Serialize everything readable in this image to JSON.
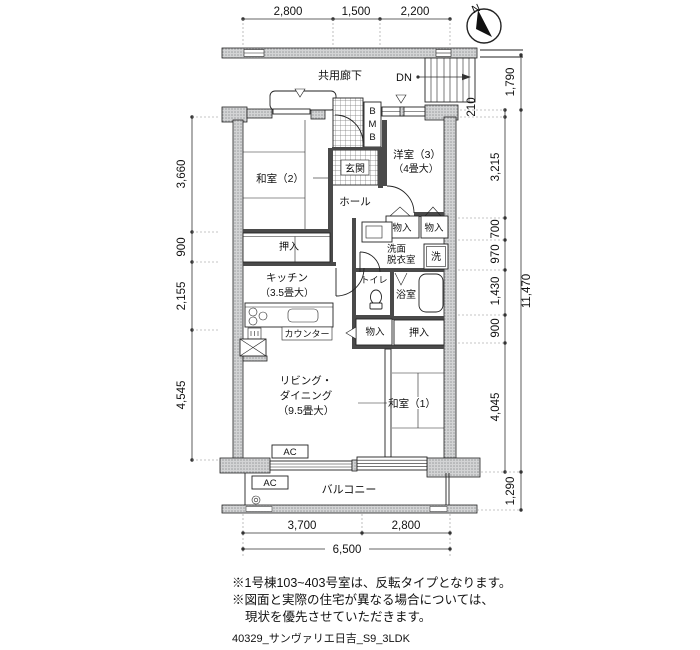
{
  "compass": {
    "north_label": "N"
  },
  "corridor": {
    "label": "共用廊下",
    "stairs_label": "DN"
  },
  "rooms": {
    "washitsu2": "和室（2）",
    "washitsu1": "和室（1）",
    "yoshitsu3_line1": "洋室（3）",
    "yoshitsu3_line2": "（4畳大）",
    "genkan": "玄関",
    "hall": "ホール",
    "kitchen_line1": "キッチン",
    "kitchen_line2": "（3.5畳大）",
    "living_line1": "リビング・",
    "living_line2": "ダイニング",
    "living_line3": "（9.5畳大）",
    "senmen_line1": "洗面",
    "senmen_line2": "脱衣室",
    "washer": "洗",
    "toilet": "トイレ",
    "bath": "浴室",
    "oshiire_top": "押入",
    "oshiire_right": "押入",
    "monoire_a": "物入",
    "monoire_b": "物入",
    "monoire_c": "物入",
    "counter": "カウンター",
    "balcony": "バルコニー",
    "mb": [
      "B",
      "M",
      "B"
    ],
    "ac1": "AC",
    "ac2": "AC"
  },
  "dimensions": {
    "top": [
      "2,800",
      "1,500",
      "2,200"
    ],
    "left": [
      "3,660",
      "900",
      "2,155",
      "4,545"
    ],
    "right_inner": [
      "210",
      "3,215",
      "700",
      "970",
      "1,430",
      "900",
      "4,045"
    ],
    "right_outer": [
      "1,790",
      "11,470",
      "1,290"
    ],
    "bottom": [
      "3,700",
      "2,800",
      "6,500"
    ]
  },
  "notes": {
    "line1": "※1号棟103~403号室は、反転タイプとなります。",
    "line2": "※図面と実際の住宅が異なる場合については、",
    "line3": "現状を優先させていただきます。"
  },
  "footer": {
    "filename": "40329_サンヴァリエ日吉_S9_3LDK"
  }
}
